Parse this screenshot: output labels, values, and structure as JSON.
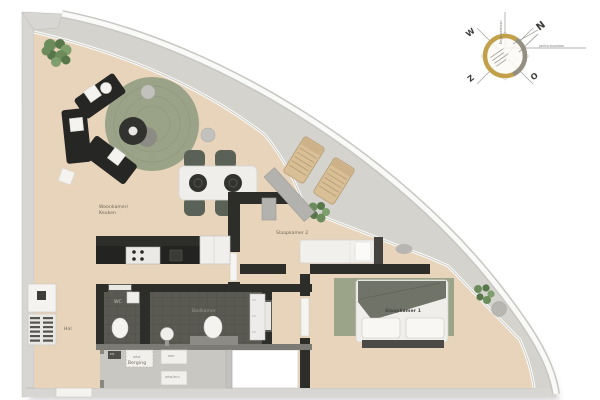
{
  "rooms": {
    "living": {
      "line1": "Woonkamer/",
      "line2": "Keuken"
    },
    "bedroom2": "Slaapkamer 2",
    "bedroom1": "Slaapkamer 1",
    "bathroom": "Badkamer",
    "wc": "WC",
    "hall": "Hal",
    "storage": "Berging"
  },
  "utilities": {
    "cv": "cv",
    "mid": "wtw",
    "right": "wm",
    "bottom": "wtw/mv"
  },
  "compass": {
    "n": "N",
    "e": "O",
    "s": "Z",
    "w": "W",
    "street_vertical": "Engelandlaan",
    "street_horizontal": "Jonkvrouwlaan"
  },
  "colors": {
    "floor": "#e8d4ba",
    "dark_tile": "#5a5952",
    "storage_floor": "#c9c7c2",
    "concrete": "#d4d3ce",
    "wall_dark": "#2d2d2a",
    "rug_green": "#9aa287",
    "compass_gold": "#c3a04a",
    "wood": "#d9bf96"
  }
}
